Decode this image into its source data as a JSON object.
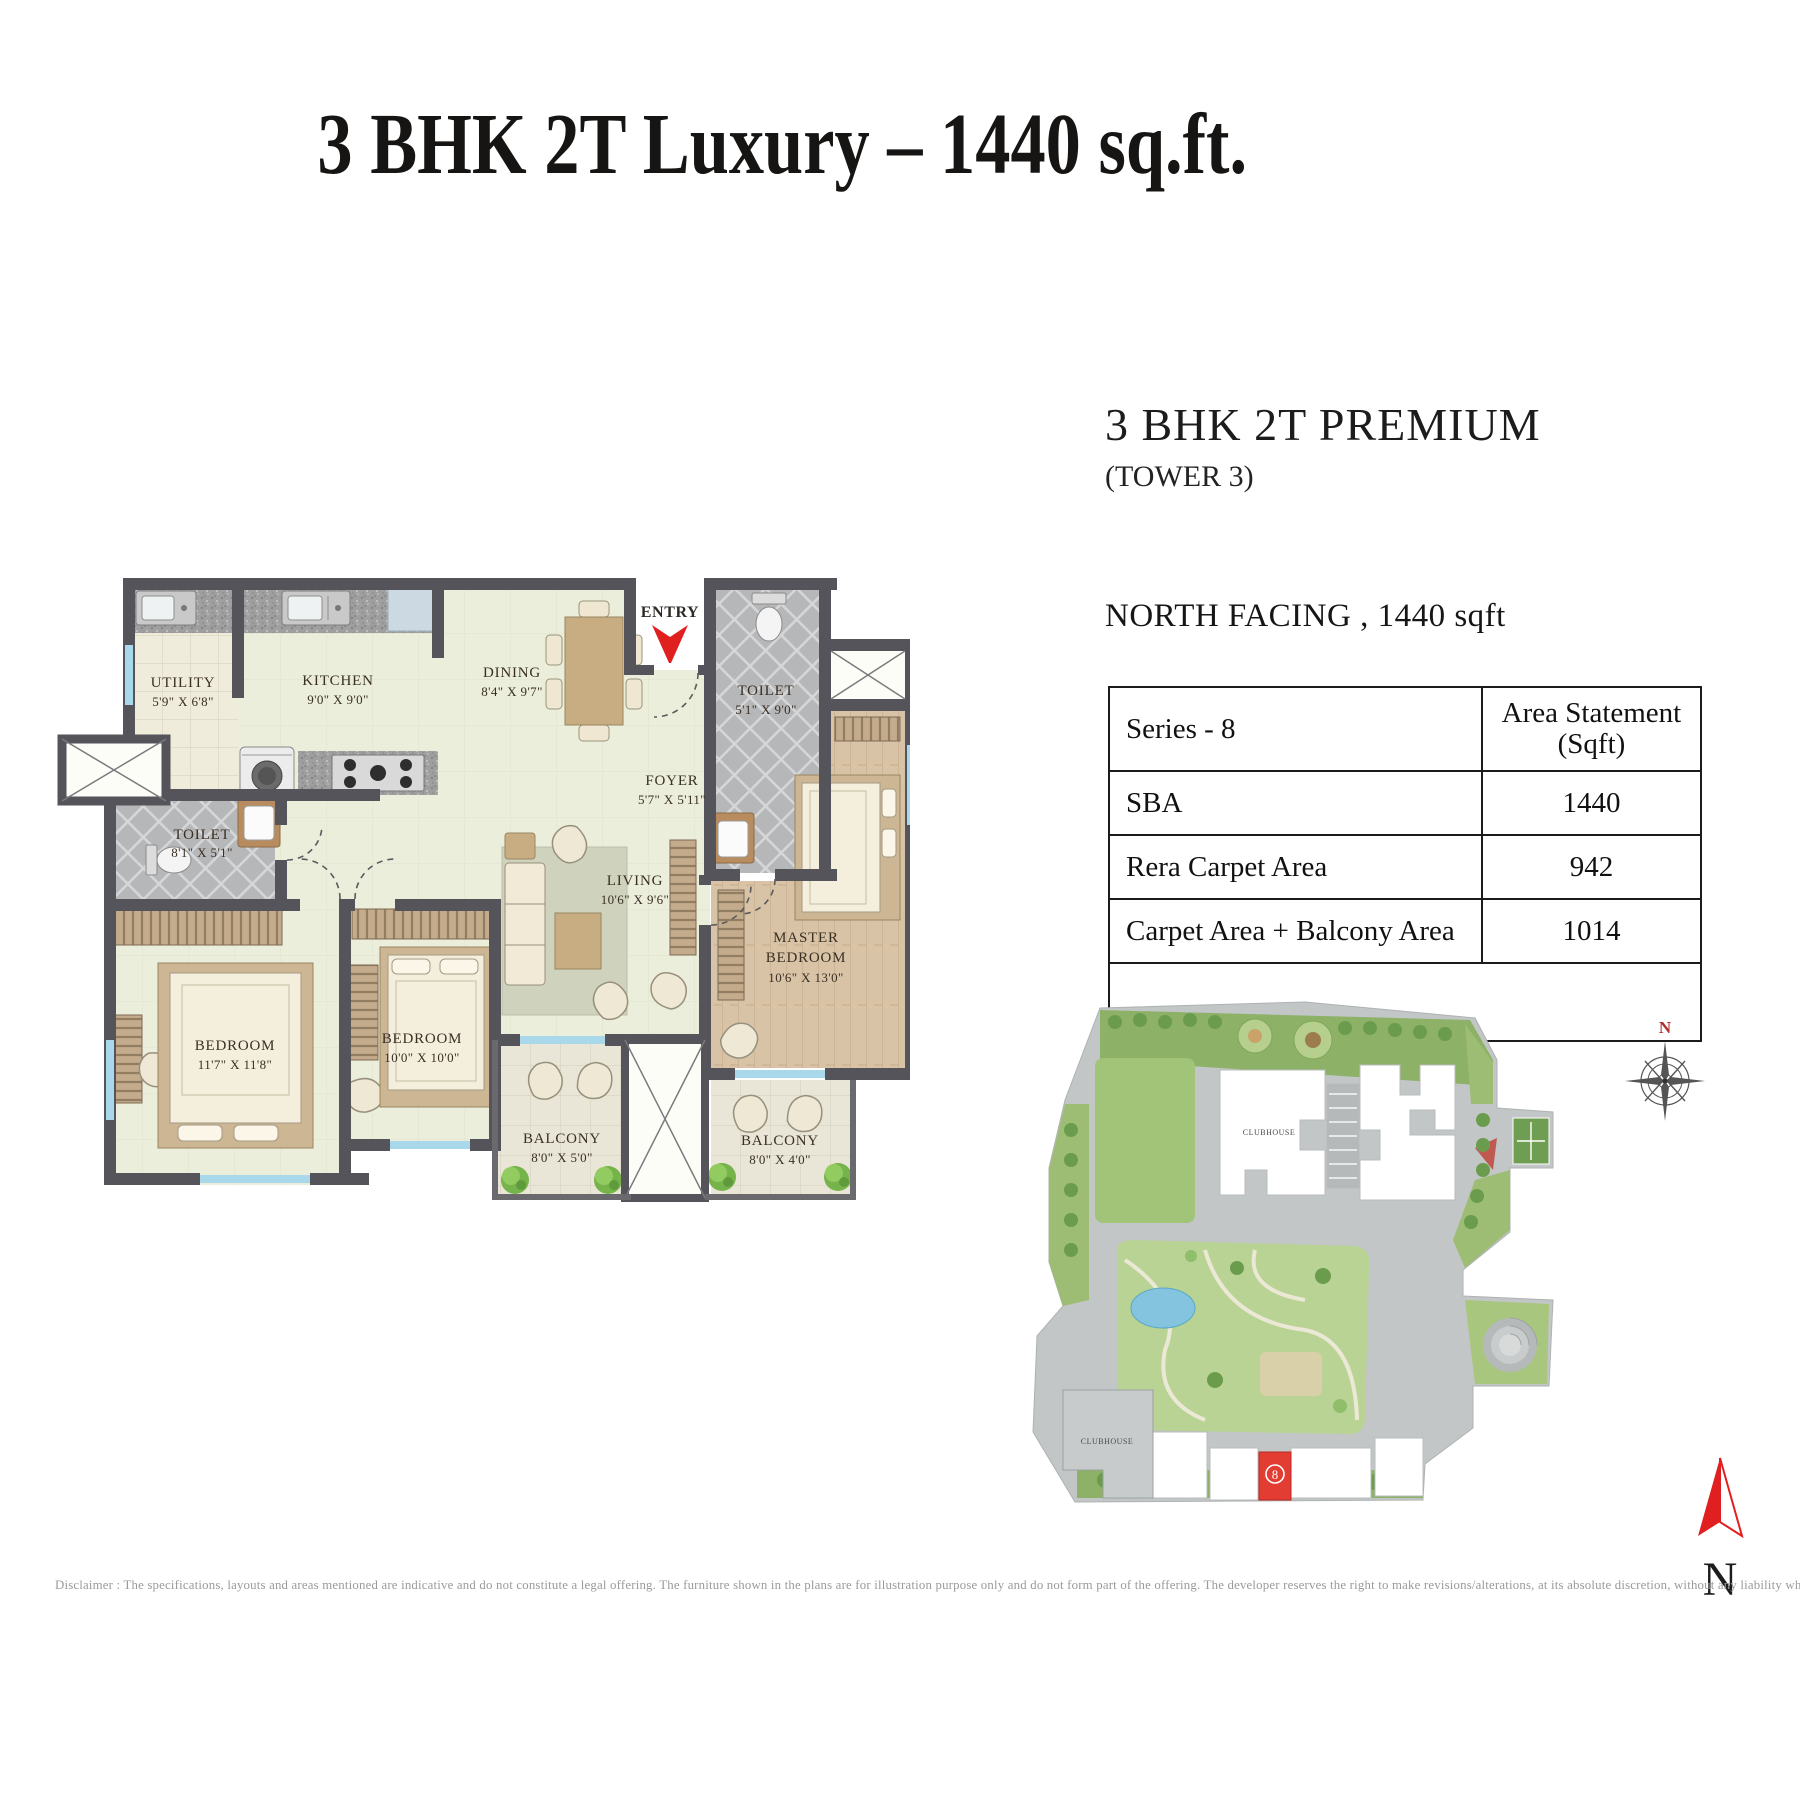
{
  "page": {
    "title": "3 BHK 2T Luxury – 1440 sq.ft.",
    "disclaimer": "Disclaimer : The specifications, layouts and areas mentioned are indicative and do not constitute a legal offering. The furniture shown in the plans are for illustration purpose only and do not form part of the offering. The developer reserves the right to make revisions/alterations, at its absolute discretion, without any liability whatsoever"
  },
  "details": {
    "heading": "3 BHK 2T PREMIUM",
    "subheading": "(TOWER 3)",
    "facing_line": "NORTH FACING , 1440 sqft",
    "table": {
      "col1_header": "Series - 8",
      "col2_header_line1": "Area Statement",
      "col2_header_line2": "(Sqft)",
      "rows": [
        {
          "label": "SBA",
          "value": "1440"
        },
        {
          "label": "Rera Carpet Area",
          "value": "942"
        },
        {
          "label": "Carpet Area + Balcony Area",
          "value": "1014"
        }
      ]
    }
  },
  "floorplan": {
    "entry_label": "ENTRY",
    "rooms": {
      "utility": {
        "name": "UTILITY",
        "dims": "5'9\" X 6'8\""
      },
      "kitchen": {
        "name": "KITCHEN",
        "dims": "9'0\" X 9'0\""
      },
      "dining": {
        "name": "DINING",
        "dims": "8'4\" X 9'7\""
      },
      "foyer": {
        "name": "FOYER",
        "dims": "5'7\" X 5'11\""
      },
      "toilet_top": {
        "name": "TOILET",
        "dims": "5'1\" X 9'0\""
      },
      "toilet_left": {
        "name": "TOILET",
        "dims": "8'1\" X 5'1\""
      },
      "living": {
        "name": "LIVING",
        "dims": "10'6\" X 9'6\""
      },
      "master": {
        "name1": "MASTER",
        "name2": "BEDROOM",
        "dims": "10'6\" X 13'0\""
      },
      "bedroom2": {
        "name": "BEDROOM",
        "dims": "10'0\" X 10'0\""
      },
      "bedroom1": {
        "name": "BEDROOM",
        "dims": "11'7\" X 11'8\""
      },
      "balcony_left": {
        "name": "BALCONY",
        "dims": "8'0\" X 5'0\""
      },
      "balcony_right": {
        "name": "BALCONY",
        "dims": "8'0\" X 4'0\""
      }
    }
  },
  "sitemap": {
    "clubhouse_top": "CLUBHOUSE",
    "clubhouse_bottom": "CLUBHOUSE",
    "tower_label": "8",
    "compass_label": "N"
  },
  "north": {
    "label": "N"
  },
  "colors": {
    "accent_red": "#e01f1f",
    "wall": "#54545a",
    "floor": "#ebeeda",
    "wood": "#d8c3a6",
    "tile_grey": "#b8b9bb",
    "window_blue": "#a8d8ea",
    "site_green": "#a2c479",
    "site_road": "#c2c6c6"
  }
}
